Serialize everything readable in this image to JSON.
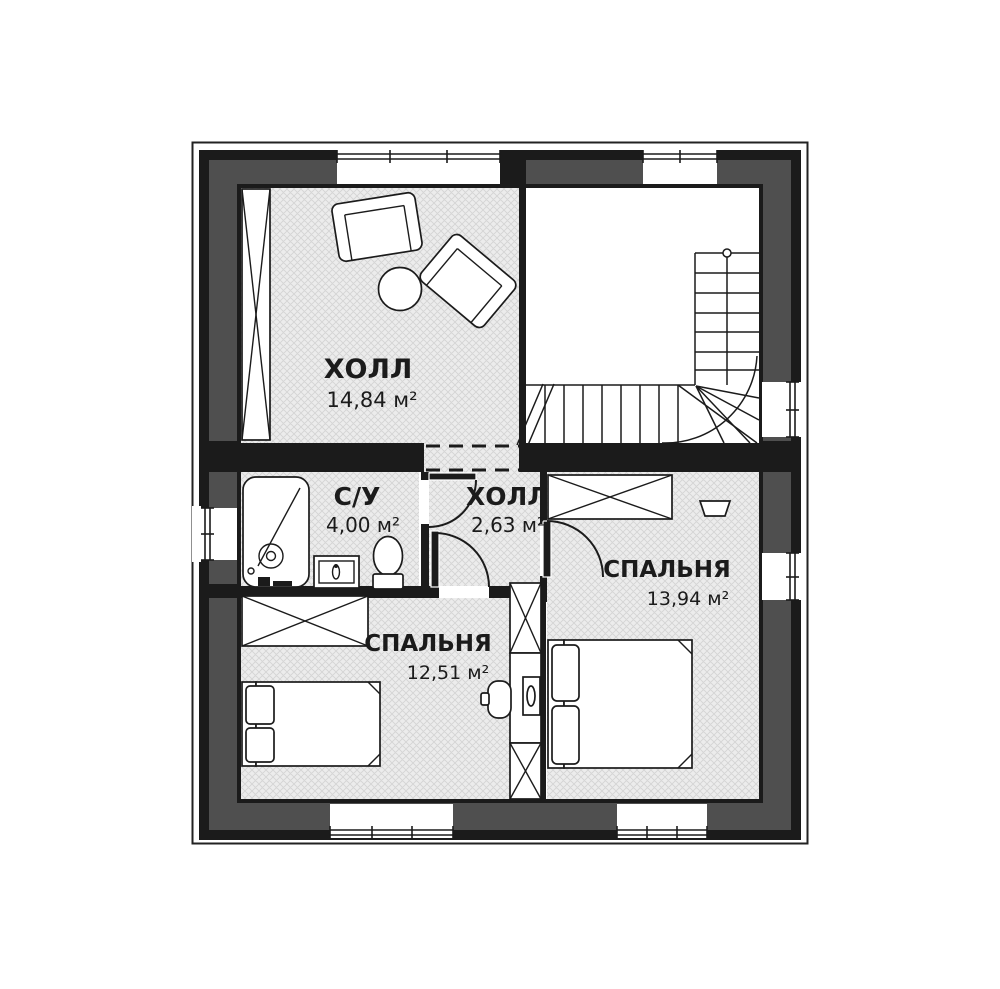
{
  "plan": {
    "type": "floor-plan",
    "floor_style": "second floor / mansard plan with winder staircase",
    "rooms": [
      {
        "id": "hall-upper",
        "label": "ХОЛЛ",
        "area": "14,84 м²"
      },
      {
        "id": "bathroom",
        "label": "С/У",
        "area": "4,00 м²"
      },
      {
        "id": "hall-small",
        "label": "ХОЛЛ",
        "area": "2,63 м²"
      },
      {
        "id": "bedroom-right",
        "label": "СПАЛЬНЯ",
        "area": "13,94 м²"
      },
      {
        "id": "bedroom-left",
        "label": "СПАЛЬНЯ",
        "area": "12,51 м²"
      }
    ],
    "colors": {
      "background": "#ffffff",
      "wall_core": "#1b1b1b",
      "wall_band": "#4f4f4f",
      "floor_hatch_base": "#ececec",
      "floor_hatch_line": "#d4d4d4",
      "line": "#1b1b1b"
    }
  }
}
